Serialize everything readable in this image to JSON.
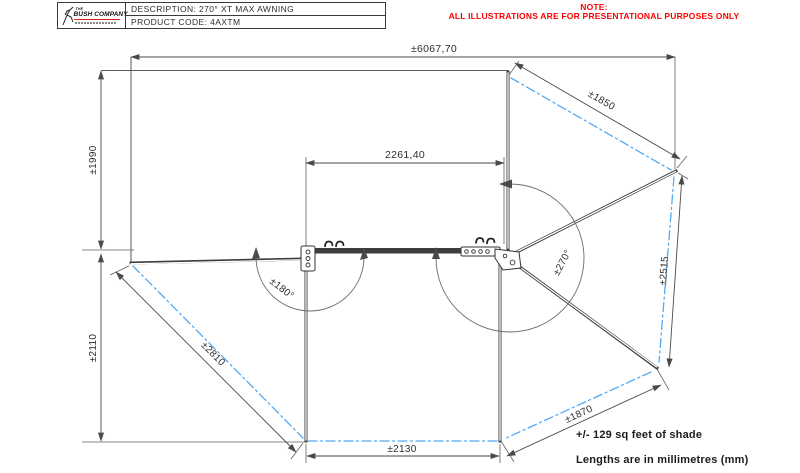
{
  "title_block": {
    "logo": {
      "the": "THE",
      "company": "BUSH COMPANY"
    },
    "description": "DESCRIPTION: 270° XT MAX AWNING",
    "product_code": "PRODUCT CODE: 4AXTM"
  },
  "warning_note": {
    "line1": "NOTE:",
    "line2": "ALL ILLUSTRATIONS ARE FOR PRESENTATIONAL PURPOSES ONLY",
    "color": "#ff0000"
  },
  "drawing": {
    "type": "plan-view technical drawing of 270° XT MAX awning",
    "dimensions": {
      "overall_width": "±6067,70",
      "rear_depth": "±1990",
      "mount_rail_length": "2261,40",
      "side_depth": "±2110",
      "left_wing_diagonal": "±2810",
      "front_width": "±2130",
      "right_wing_lower_edge": "±1870",
      "right_wing_outer_edge": "±2515",
      "right_wing_upper_edge": "±1850",
      "sweep_angle_right": "±270°",
      "sweep_angle_left": "±180°"
    },
    "notes": {
      "shade_area": "+/- 129 sq feet of shade",
      "units": "Lengths are in millimetres (mm)"
    },
    "colors": {
      "fabric_centerline_blue": "#55a9f2",
      "dimension_gray": "#4a4a4a",
      "frame_dark": "#3d3d3d",
      "note_red": "#ff0000"
    }
  }
}
